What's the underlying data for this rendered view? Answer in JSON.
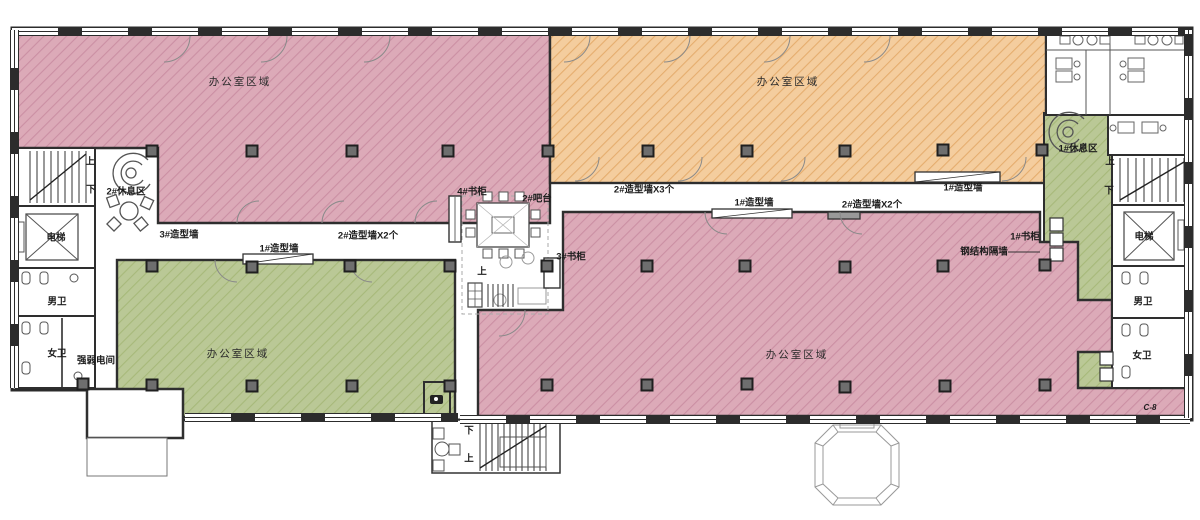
{
  "plan": {
    "type": "architectural-floor-plan",
    "zones": [
      {
        "id": "office-nw",
        "label": "办公室区域",
        "color_key": "pink"
      },
      {
        "id": "office-ne",
        "label": "办公室区域",
        "color_key": "orange"
      },
      {
        "id": "office-sw",
        "label": "办公室区域",
        "color_key": "green"
      },
      {
        "id": "office-se",
        "label": "办公室区域",
        "color_key": "pink"
      },
      {
        "id": "corridor-east",
        "label": "",
        "color_key": "green"
      }
    ]
  },
  "colors": {
    "pink": "#dcaab8",
    "pinkLine": "#cb8fa3",
    "orange": "#f4cd9e",
    "orangeLine": "#e5ad6e",
    "green": "#bac896",
    "greenLine": "#a7b97a",
    "wall": "#2e2e2e",
    "column": "#6e6e6e"
  },
  "labels": [
    {
      "id": "zone-nw",
      "text": "办公室区域",
      "x": 240,
      "y": 82,
      "cls": "zone"
    },
    {
      "id": "zone-ne",
      "text": "办公室区域",
      "x": 788,
      "y": 82,
      "cls": "zone"
    },
    {
      "id": "zone-sw",
      "text": "办公室区域",
      "x": 238,
      "y": 354,
      "cls": "zone"
    },
    {
      "id": "zone-se",
      "text": "办公室区域",
      "x": 797,
      "y": 355,
      "cls": "zone"
    },
    {
      "id": "stair-up-left",
      "text": "上",
      "x": 90,
      "y": 162
    },
    {
      "id": "stair-down-left",
      "text": "下",
      "x": 91,
      "y": 190
    },
    {
      "id": "rest-area-2",
      "text": "2#休息区",
      "x": 126,
      "y": 192
    },
    {
      "id": "elevator-left",
      "text": "电梯",
      "x": 56,
      "y": 238
    },
    {
      "id": "wall-3-label",
      "text": "3#造型墙",
      "x": 179,
      "y": 235
    },
    {
      "id": "wall-1-left-label",
      "text": "1#造型墙",
      "x": 279,
      "y": 249
    },
    {
      "id": "wall-2x2-left-label",
      "text": "2#造型墙X2个",
      "x": 368,
      "y": 236
    },
    {
      "id": "wc-men-left",
      "text": "男卫",
      "x": 57,
      "y": 302
    },
    {
      "id": "wc-women-left",
      "text": "女卫",
      "x": 57,
      "y": 354
    },
    {
      "id": "elec-room",
      "text": "强弱电间",
      "x": 96,
      "y": 361
    },
    {
      "id": "bookcase-4",
      "text": "4#书柜",
      "x": 472,
      "y": 192
    },
    {
      "id": "bar-2",
      "text": "2#吧台",
      "x": 537,
      "y": 199
    },
    {
      "id": "wall-2x3-label",
      "text": "2#造型墙X3个",
      "x": 644,
      "y": 190
    },
    {
      "id": "wall-1-mid-label",
      "text": "1#造型墙",
      "x": 754,
      "y": 203
    },
    {
      "id": "wall-2x2-mid-label",
      "text": "2#造型墙X2个",
      "x": 872,
      "y": 205
    },
    {
      "id": "wall-1-right-label",
      "text": "1#造型墙",
      "x": 963,
      "y": 188
    },
    {
      "id": "bookcase-3",
      "text": "3#书柜",
      "x": 571,
      "y": 257
    },
    {
      "id": "stair-up-center",
      "text": "上",
      "x": 482,
      "y": 272
    },
    {
      "id": "rest-area-1",
      "text": "1#休息区",
      "x": 1078,
      "y": 149
    },
    {
      "id": "stair-up-right",
      "text": "上",
      "x": 1110,
      "y": 162
    },
    {
      "id": "stair-down-right",
      "text": "下",
      "x": 1109,
      "y": 191
    },
    {
      "id": "elevator-right",
      "text": "电梯",
      "x": 1144,
      "y": 237
    },
    {
      "id": "bookcase-1",
      "text": "1#书柜",
      "x": 1025,
      "y": 237
    },
    {
      "id": "steel-partition",
      "text": "钢结构隔墙",
      "x": 984,
      "y": 252
    },
    {
      "id": "wc-men-right",
      "text": "男卫",
      "x": 1143,
      "y": 302
    },
    {
      "id": "wc-women-right",
      "text": "女卫",
      "x": 1142,
      "y": 356
    },
    {
      "id": "grid-ref",
      "text": "C-8",
      "x": 1150,
      "y": 408,
      "cls": "tiny"
    },
    {
      "id": "stair-down-entrance",
      "text": "下",
      "x": 469,
      "y": 431
    },
    {
      "id": "stair-up-entrance",
      "text": "上",
      "x": 469,
      "y": 459
    }
  ],
  "columns": {
    "positions": [
      [
        152,
        151
      ],
      [
        252,
        151
      ],
      [
        352,
        151
      ],
      [
        448,
        151
      ],
      [
        548,
        151
      ],
      [
        648,
        151
      ],
      [
        747,
        151
      ],
      [
        845,
        151
      ],
      [
        943,
        150
      ],
      [
        1042,
        150
      ],
      [
        152,
        266
      ],
      [
        252,
        267
      ],
      [
        350,
        266
      ],
      [
        450,
        266
      ],
      [
        547,
        266
      ],
      [
        647,
        266
      ],
      [
        745,
        266
      ],
      [
        845,
        267
      ],
      [
        943,
        266
      ],
      [
        1045,
        265
      ],
      [
        83,
        384
      ],
      [
        152,
        385
      ],
      [
        252,
        386
      ],
      [
        352,
        386
      ],
      [
        450,
        386
      ],
      [
        547,
        385
      ],
      [
        647,
        385
      ],
      [
        747,
        384
      ],
      [
        845,
        387
      ],
      [
        945,
        386
      ],
      [
        1045,
        385
      ]
    ]
  }
}
